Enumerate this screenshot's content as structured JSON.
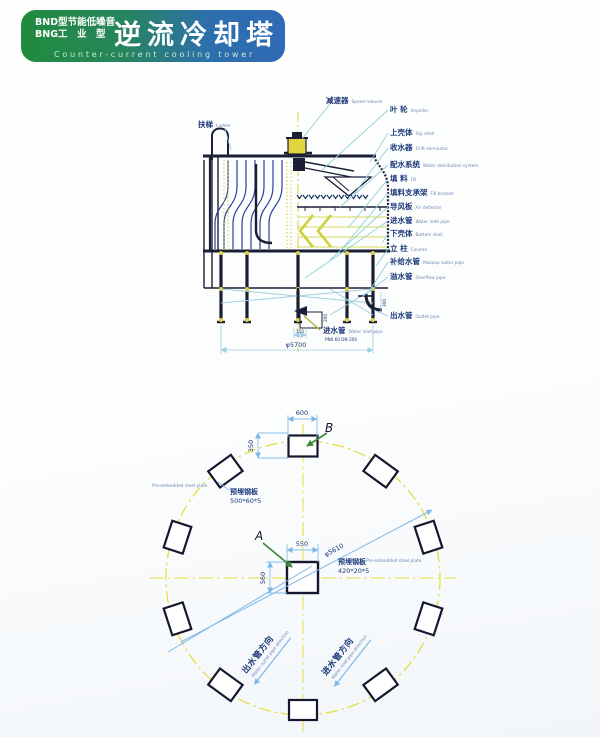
{
  "header": {
    "model_line1": "BND型节能低噪音",
    "model_line2": "BNG工　业　型",
    "title": "逆流冷却塔",
    "subtitle": "Counter-current cooling tower",
    "color_left": "#1f8b3e",
    "color_right": "#2f6ab6"
  },
  "tower_diagram": {
    "top_label": {
      "cn": "减速器",
      "en": "Speed reducer"
    },
    "left_label": {
      "cn": "扶梯",
      "en": "Ladder"
    },
    "right_labels": [
      {
        "cn": "叶 轮",
        "en": "Impeller"
      },
      {
        "cn": "上壳体",
        "en": "Top shell"
      },
      {
        "cn": "收水器",
        "en": "Drift eliminator"
      },
      {
        "cn": "配水系统",
        "en": "Water distribution system"
      },
      {
        "cn": "填 料",
        "en": "Fill"
      },
      {
        "cn": "填料支承架",
        "en": "Fill bracket"
      },
      {
        "cn": "导风板",
        "en": "Air deflector"
      },
      {
        "cn": "进水管",
        "en": "Water inlet pipe"
      },
      {
        "cn": "下壳体",
        "en": "Bottom shell"
      },
      {
        "cn": "立 柱",
        "en": "Column"
      },
      {
        "cn": "补给水管",
        "en": "Makeup water pipe"
      },
      {
        "cn": "溢水管",
        "en": "Overflow pipe"
      },
      {
        "cn": "出水管",
        "en": "Outlet pipe"
      }
    ],
    "bottom_label": {
      "cn": "进水管",
      "en": "Water inlet pipe",
      "spec": "PN6 60 DN 200"
    },
    "dims": {
      "base_diameter": "φ5700",
      "inlet_width": "150",
      "inlet_height": "200",
      "outlet_height": "300"
    }
  },
  "plan_diagram": {
    "marker_a": "A",
    "marker_b": "B",
    "dims": {
      "plate_b_width": "600",
      "plate_b_offset": "350",
      "plate_a_width": "550",
      "plate_a_height": "560",
      "bolt_circle": "φ5610"
    },
    "plate_note_left": {
      "cn": "预埋钢板",
      "size": "500*60*5",
      "en": "Pre-embedded steel plate"
    },
    "plate_note_right": {
      "cn": "预埋钢板",
      "size": "420*20*5",
      "en": "Pre-embedded steel plate"
    },
    "outlet_direction": {
      "cn": "出水管方向",
      "en": "Water outlet pipe direction"
    },
    "inlet_direction": {
      "cn": "进水管方向",
      "en": "Water inlet pipe direction"
    }
  }
}
